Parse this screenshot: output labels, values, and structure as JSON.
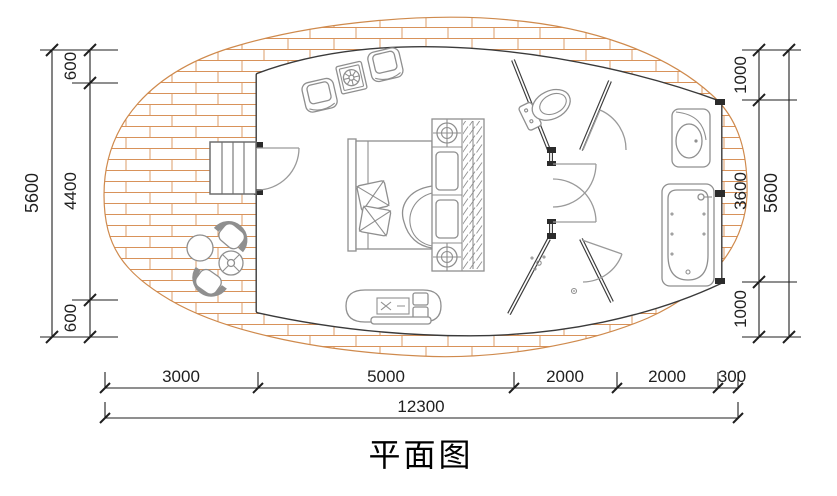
{
  "title": "平面图",
  "dimensions": {
    "left_outer": "5600",
    "left_inner": [
      "600",
      "4400",
      "600"
    ],
    "right_inner": [
      "1000",
      "3600",
      "1000"
    ],
    "right_outer": "5600",
    "bottom_segments": [
      "3000",
      "5000",
      "2000",
      "2000",
      "300"
    ],
    "bottom_total": "12300"
  },
  "colors": {
    "deck_hatch": "#d8925a",
    "deck_outline": "#cf8a4d",
    "wall": "#3a3a3a",
    "furniture_line": "#8f8f8f",
    "dimension_line": "#1f1f1f",
    "background": "#ffffff"
  },
  "furniture": [
    "stairs",
    "outdoor-chair",
    "outdoor-table",
    "parasol-table",
    "armchair",
    "side-table",
    "double-bed",
    "pillow",
    "nightstand-lamp",
    "wardrobe",
    "tv-cabinet",
    "toilet",
    "shower-head",
    "floor-drain",
    "washbasin",
    "bathtub"
  ]
}
